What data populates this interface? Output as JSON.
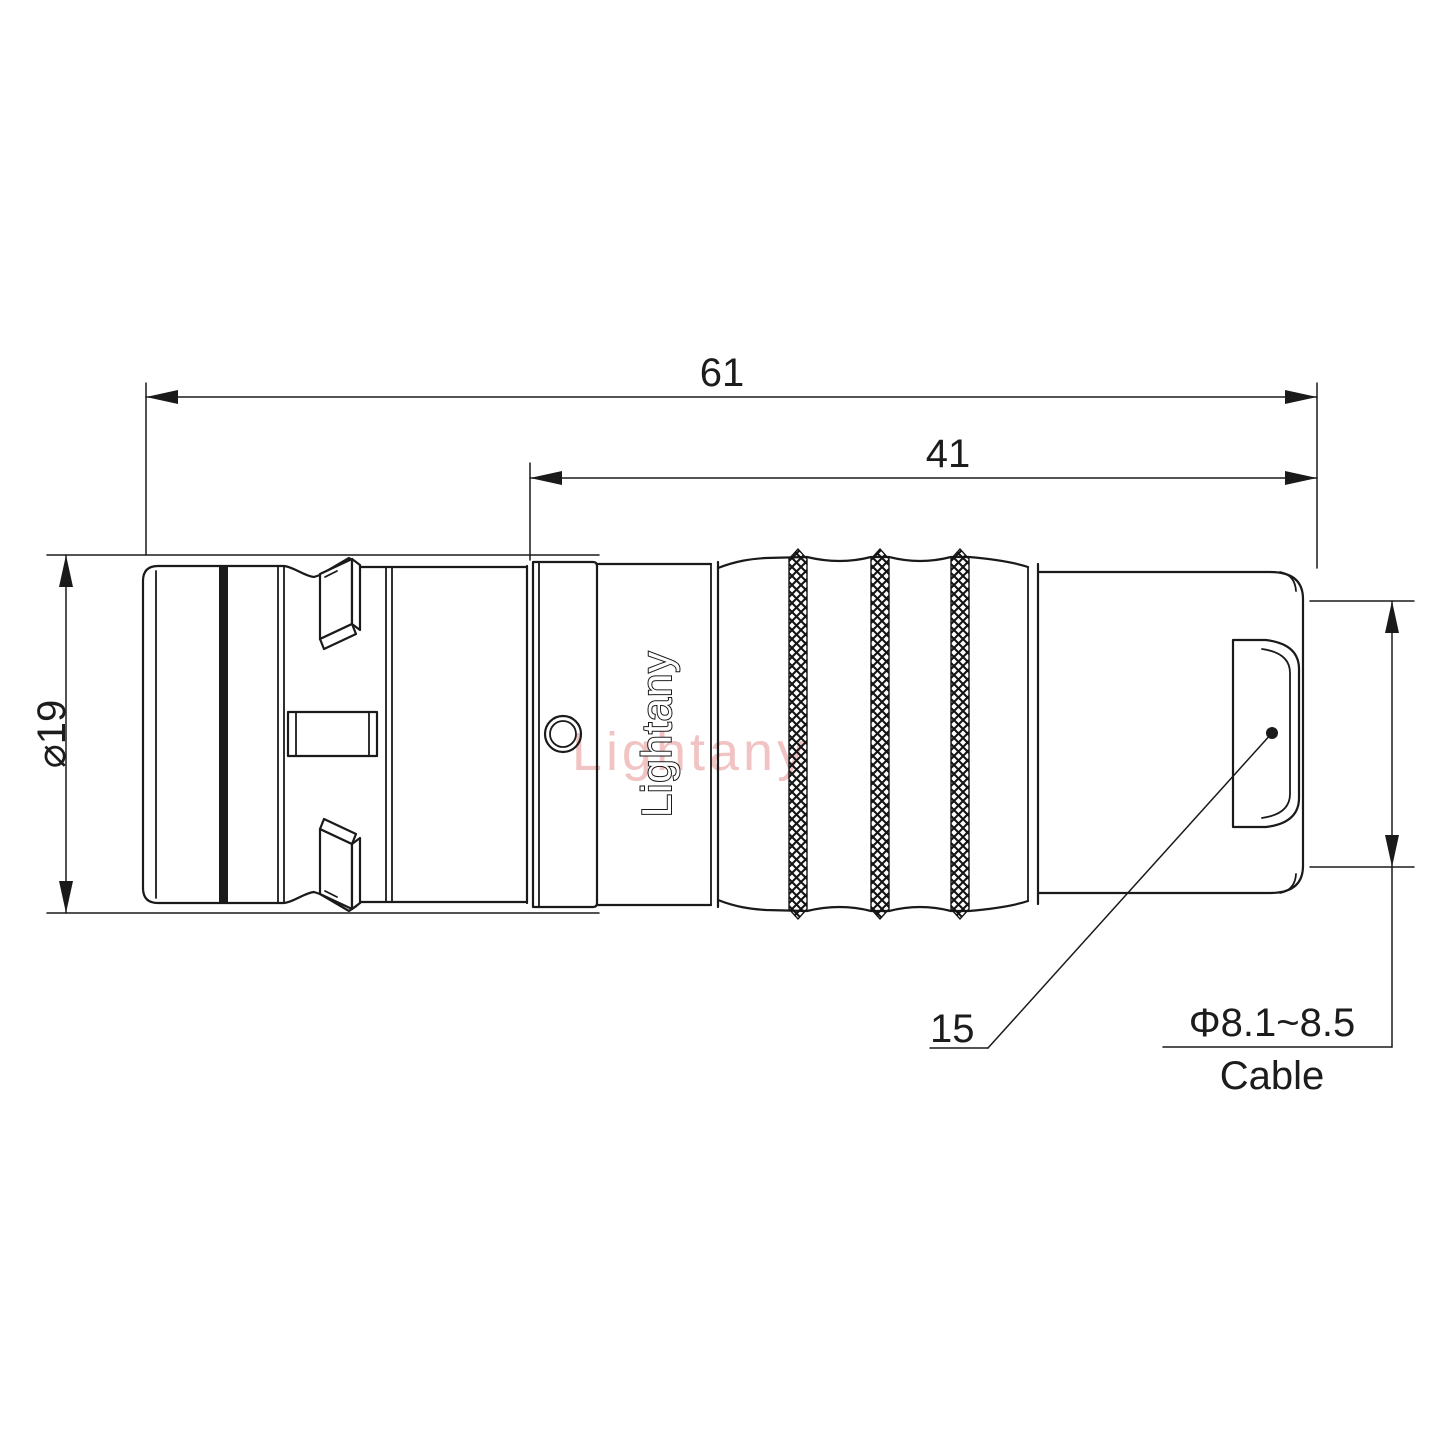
{
  "drawing": {
    "watermark_text": "Lightany",
    "brand_text": "Lightany",
    "line_color": "#1a1a1a",
    "watermark_color": "#d65050",
    "dimensions": {
      "overall_length": "61",
      "rear_length": "41",
      "body_diameter": "⌀19",
      "nut_size": "15",
      "cable_diameter": "Φ8.1~8.5",
      "cable_word": "Cable"
    }
  }
}
